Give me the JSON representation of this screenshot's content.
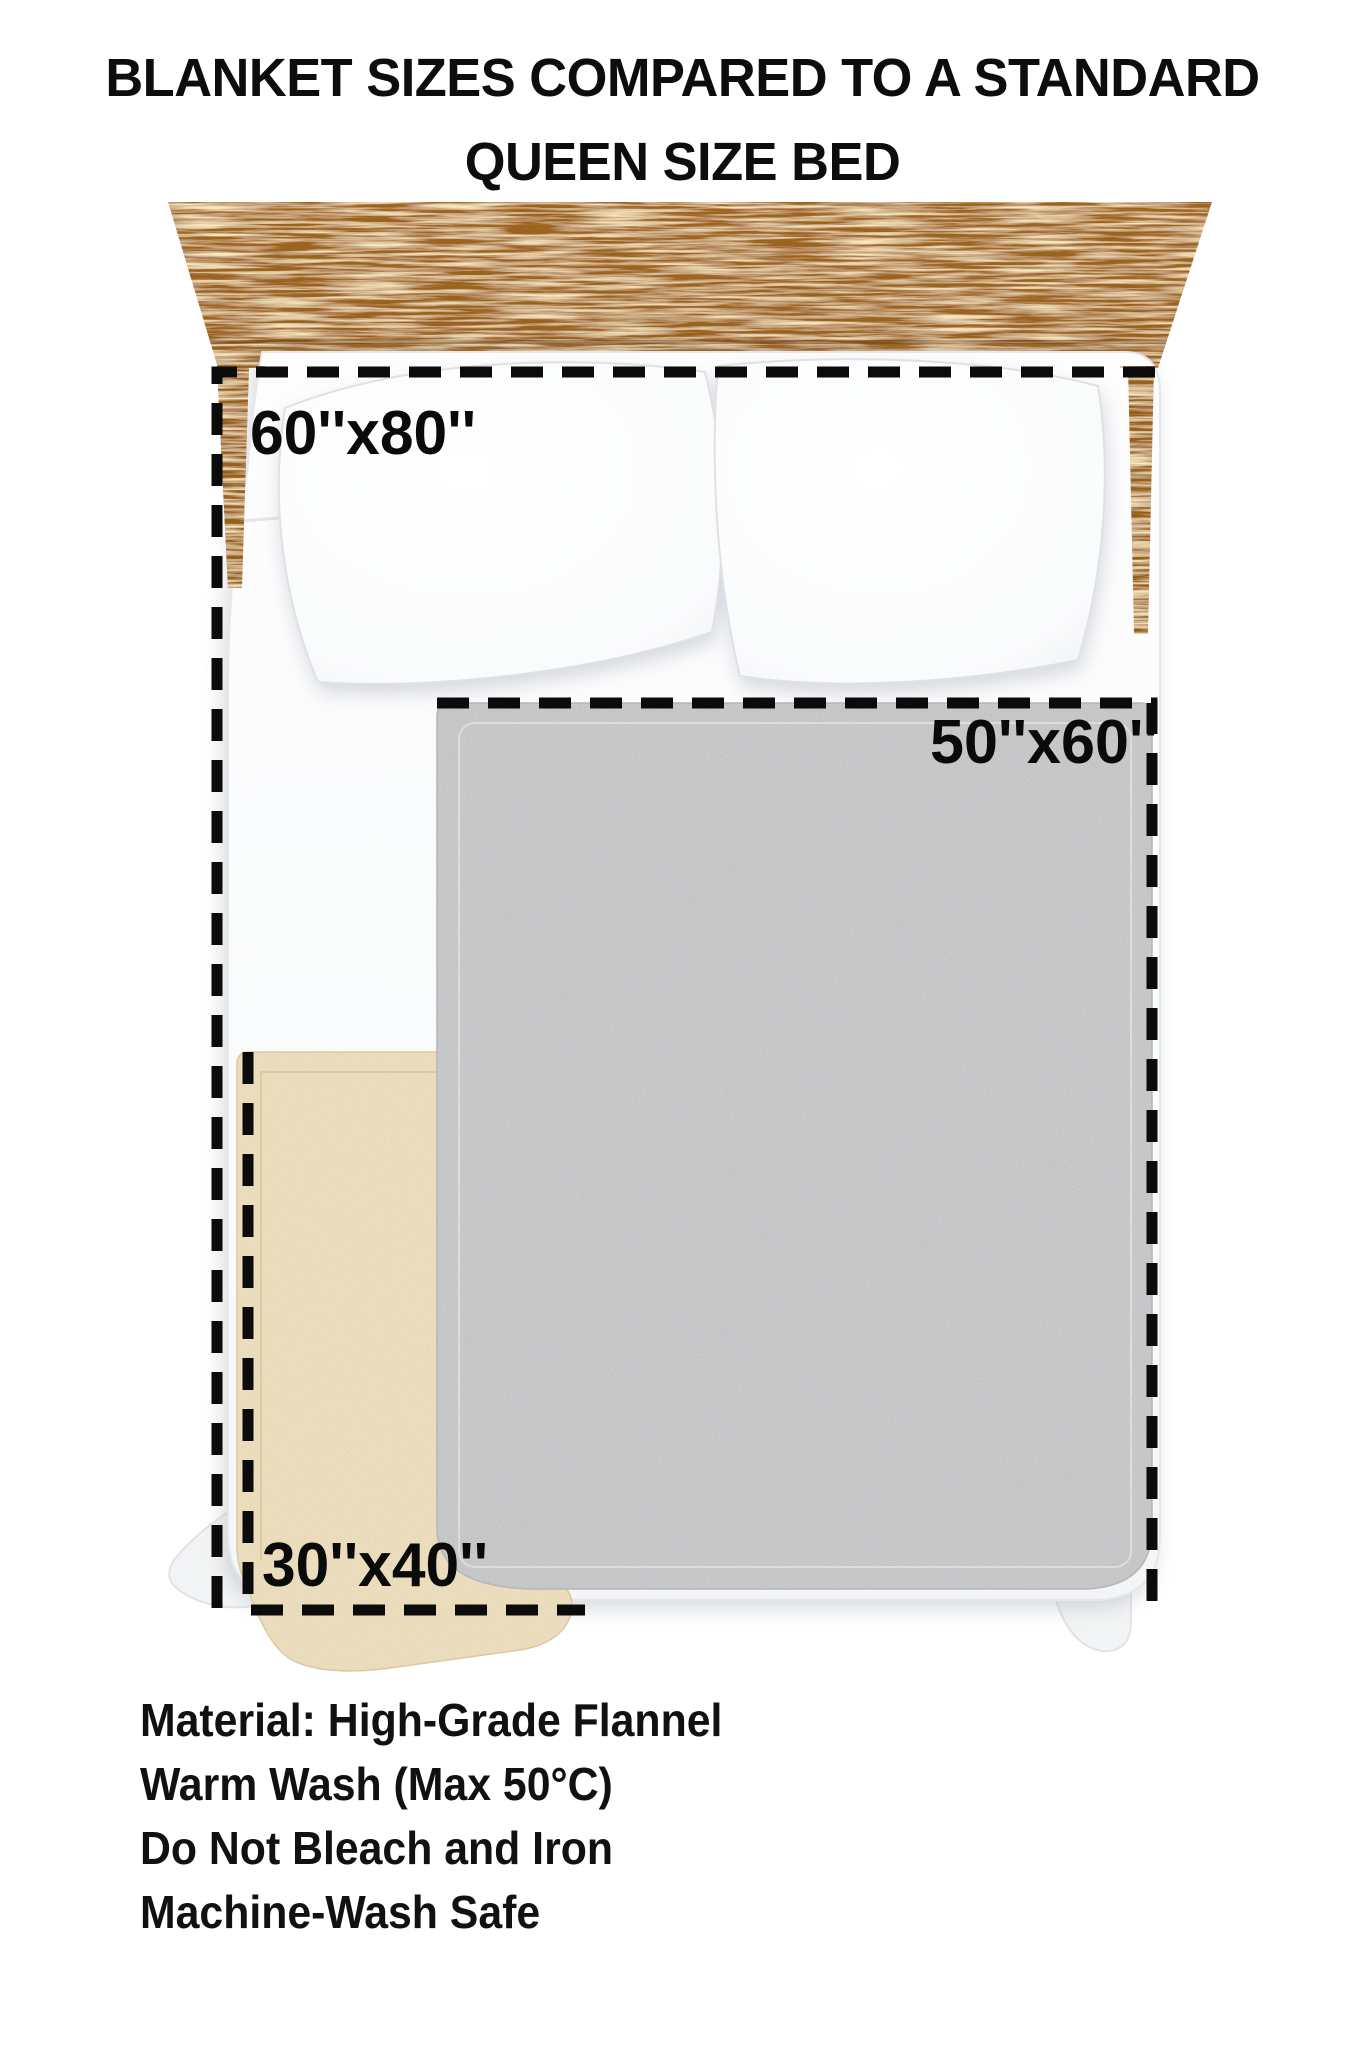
{
  "title": {
    "line1": "BLANKET SIZES COMPARED TO A STANDARD",
    "line2": "QUEEN SIZE BED"
  },
  "blankets": [
    {
      "size_label": "60''x80''",
      "outline": "dashed",
      "description_color": null
    },
    {
      "size_label": "50''x60''",
      "outline": "dashed",
      "description_color": "#cacbcc"
    },
    {
      "size_label": "30''x40''",
      "outline": "dashed",
      "description_color": "#ecdfc0"
    }
  ],
  "labels": {
    "large": "60''x80''",
    "medium": "50''x60''",
    "small": "30''x40''"
  },
  "care": {
    "line1": "Material: High-Grade Flannel",
    "line2": "Warm Wash (Max 50°C)",
    "line3": "Do Not Bleach and Iron",
    "line4": "Machine-Wash Safe"
  },
  "colors": {
    "background": "#ffffff",
    "text": "#0d0d0d",
    "dash": "#0b0b0b",
    "wood": "#a2641c",
    "gray_blanket": "#cacbcc",
    "beige_blanket": "#ecdfc0",
    "sheet_white": "#fbfcfd",
    "pillow_white": "#ffffff"
  }
}
